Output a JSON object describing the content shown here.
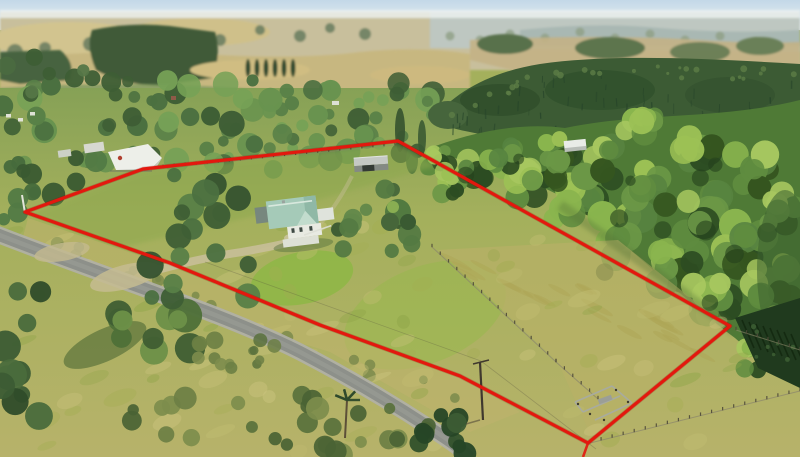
{
  "meta": {
    "domain": "natural-image",
    "description": "Aerial drone photograph of a rural lifestyle property outlined with a red boundary overlay: a house with pale teal roof among shelter trees, grey implement shed, white shed by the road entrance, open grass paddocks with internal fences and small stockyards, a sealed country road across the foreground, dense native bush and pine plantation to the right, and rolling farmland hills fading to a hazy horizon."
  },
  "scene": {
    "overlay": {
      "type": "property-boundary",
      "color": "#e3180e",
      "vertices": [
        [
          25,
          212
        ],
        [
          143,
          169
        ],
        [
          398,
          141
        ],
        [
          730,
          326
        ],
        [
          588,
          443
        ],
        [
          460,
          376
        ],
        [
          320,
          325
        ],
        [
          170,
          263
        ]
      ],
      "corner_stub": [
        [
          588,
          443
        ],
        [
          583,
          457
        ]
      ]
    },
    "features": {
      "dwelling": "single-storey house, pale teal hip roof, white walls and veranda",
      "outbuildings": [
        "grey gabled implement shed",
        "large white shed near road entrance",
        "portable stockyards in lower paddock"
      ],
      "land": "open grass paddocks, partly dry, internal fence lines",
      "surroundings": "sealed rural road in foreground, mature shelter trees, native bush and pine plantation at right, rolling farmland hills behind",
      "utilities": "timber power pole with crossarm in lower paddock, white marker pole at west corner"
    },
    "palette": {
      "sky_top": "#c3d8e8",
      "sky_bottom": "#eef3f2",
      "haze": "#bcc8c8",
      "far_land": "#c8bf9c",
      "forest_dark": "#3f5a39",
      "pine": "#3c5b34",
      "bush": "#5f8c3f",
      "grass_bright": "#8cb843",
      "grass_base": "#a4b05c",
      "grass_dry": "#b8b067",
      "road": "#8d908a",
      "roof_teal": "#a5cab8",
      "shed_white": "#edefe9",
      "barn_grey": "#848a84",
      "boundary_red": "#e3180e"
    }
  }
}
